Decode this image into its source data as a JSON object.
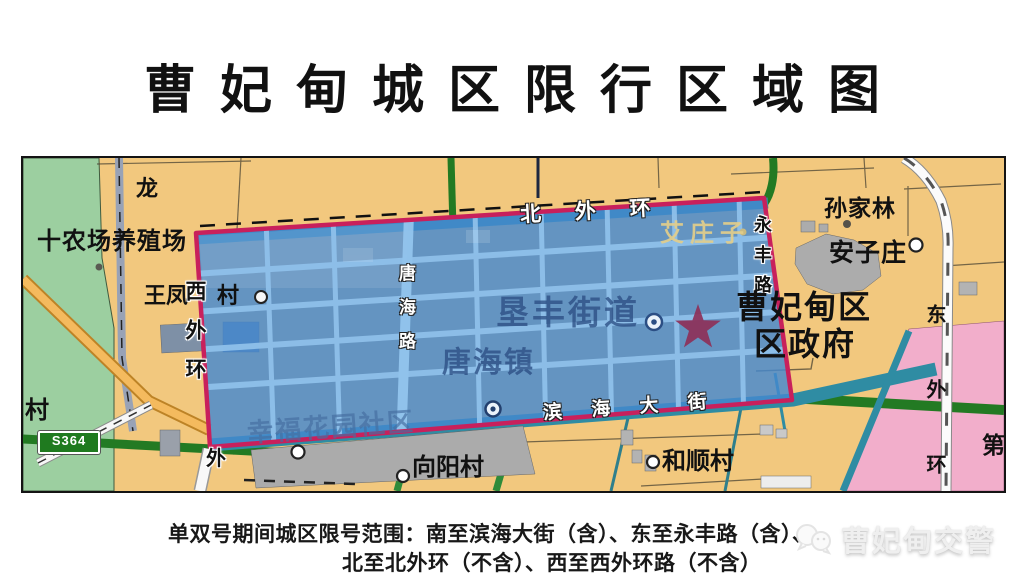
{
  "title": "曹妃甸城区限行区域图",
  "caption": {
    "line1": "单双号期间城区限号范围：南至滨海大街（含）、东至永丰路（含）、",
    "line2": "北至北外环（不含）、西至西外环路（不含）"
  },
  "watermark": {
    "text": "曹妃甸交警",
    "icon": "wechat-icon"
  },
  "map": {
    "labels": {
      "long": "龙",
      "shinongchang": "十农场养殖场",
      "wangfeng": "王凤",
      "wangfeng_cun": "村",
      "xiwaihuan": "西外环",
      "wai_south": "外",
      "beiwaihuan": "北 外 环",
      "aizhuangzi": "艾庄子",
      "yongfenglu": "永丰路",
      "sunjialin": "孙家林",
      "anzizhuang": "安子庄",
      "district_l1": "曹妃甸区",
      "district_l2": "区政府",
      "kenfeng": "垦丰街道",
      "tanghaizhen": "唐海镇",
      "tanghailu": "唐海路",
      "binhaidajie": "滨 海 大 街",
      "xingfu": "幸福花园社区",
      "xiangyangcun": "向阳村",
      "heshuncun": "和顺村",
      "dongwaihuan": "东外环",
      "di": "第",
      "cun_left": "村",
      "s364": "S364"
    },
    "colors": {
      "restricted_zone_blue": "#4489CF",
      "boundary_red": "#C8205C",
      "road_teal": "#2F8CA3",
      "road_green": "#237A23",
      "farm_green": "#9CCFA0",
      "district_pink": "#F2AECB",
      "land_tan": "#F2C87E",
      "star_red": "#8E2D57"
    }
  }
}
